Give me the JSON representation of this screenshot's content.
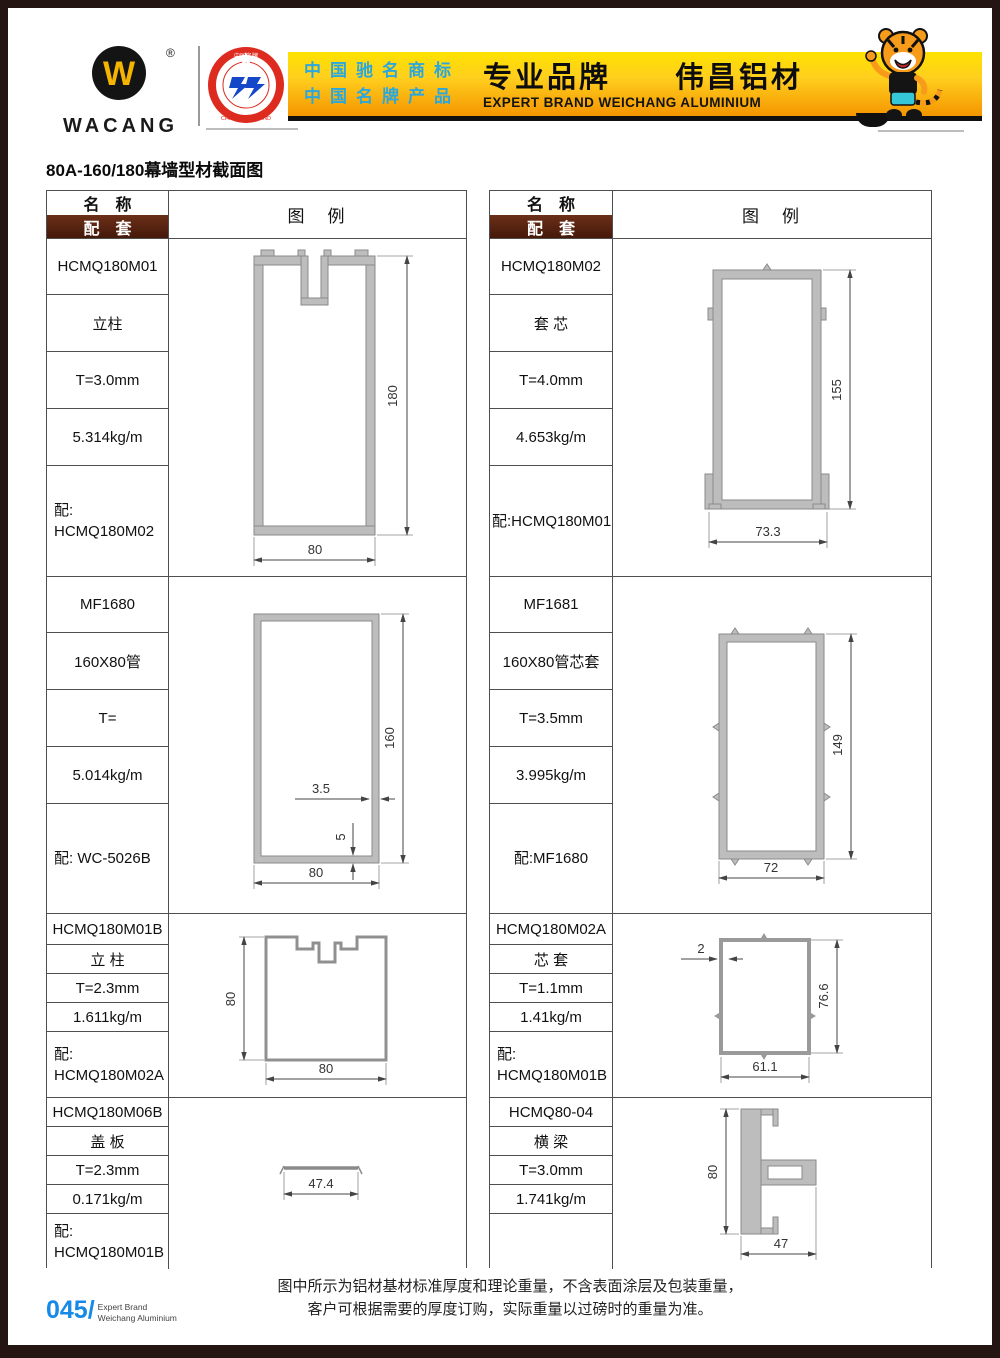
{
  "header": {
    "logo": {
      "text": "WACANG",
      "reg": "®"
    },
    "badge": {
      "top": "中国名牌",
      "bottom": "CHINA TOP BRAND"
    },
    "banner": {
      "line1": "中国驰名商标",
      "line2": "中国名牌产品",
      "title": "专业品牌　　伟昌铝材",
      "subtitle": "EXPERT BRAND WEICHANG ALUMINIUM"
    }
  },
  "page": {
    "title": "80A-160/180幕墙型材截面图",
    "note1": "图中所示为铝材基材标准厚度和理论重量，不含表面涂层及包装重量，",
    "note2": "客户可根据需要的厚度订购，实际重量以过磅时的重量为准。",
    "number": "045/",
    "brand1": "Expert Brand",
    "brand2": "Weichang Aluminium"
  },
  "table": {
    "name_header": "名　称",
    "match_header": "配　套",
    "legend_header": "图　例"
  },
  "sections": {
    "left": [
      {
        "code": "HCMQ180M01",
        "name": "立柱",
        "thickness": "T=3.0mm",
        "weight": "5.314kg/m",
        "match1": "配:",
        "match2": "HCMQ180M02",
        "dims": {
          "h": "180",
          "w": "80"
        }
      },
      {
        "code": "MF1680",
        "name": "160X80管",
        "thickness": "T=",
        "weight": "5.014kg/m",
        "match1": "配: WC-5026B",
        "match2": "",
        "dims": {
          "h": "160",
          "w": "80",
          "t1": "3.5",
          "t2": "5"
        }
      },
      {
        "code": "HCMQ180M01B",
        "name": "立 柱",
        "thickness": "T=2.3mm",
        "weight": "1.611kg/m",
        "match1": "配:",
        "match2": "HCMQ180M02A",
        "dims": {
          "h": "80",
          "w": "80"
        }
      },
      {
        "code": "HCMQ180M06B",
        "name": "盖 板",
        "thickness": "T=2.3mm",
        "weight": "0.171kg/m",
        "match1": "配:",
        "match2": "HCMQ180M01B",
        "dims": {
          "w": "47.4"
        }
      }
    ],
    "right": [
      {
        "code": "HCMQ180M02",
        "name": "套 芯",
        "thickness": "T=4.0mm",
        "weight": "4.653kg/m",
        "match1": "配:HCMQ180M01",
        "match2": "",
        "dims": {
          "h": "155",
          "w": "73.3"
        }
      },
      {
        "code": "MF1681",
        "name": "160X80管芯套",
        "thickness": "T=3.5mm",
        "weight": "3.995kg/m",
        "match1": "配:MF1680",
        "match2": "",
        "dims": {
          "h": "149",
          "w": "72"
        }
      },
      {
        "code": "HCMQ180M02A",
        "name": "芯 套",
        "thickness": "T=1.1mm",
        "weight": "1.41kg/m",
        "match1": "配:",
        "match2": "HCMQ180M01B",
        "dims": {
          "h": "76.6",
          "w": "61.1",
          "t1": "2"
        }
      },
      {
        "code": "HCMQ80-04",
        "name": "横 梁",
        "thickness": "T=3.0mm",
        "weight": "1.741kg/m",
        "match1": "",
        "match2": "",
        "dims": {
          "h": "80",
          "w": "47"
        }
      }
    ]
  }
}
